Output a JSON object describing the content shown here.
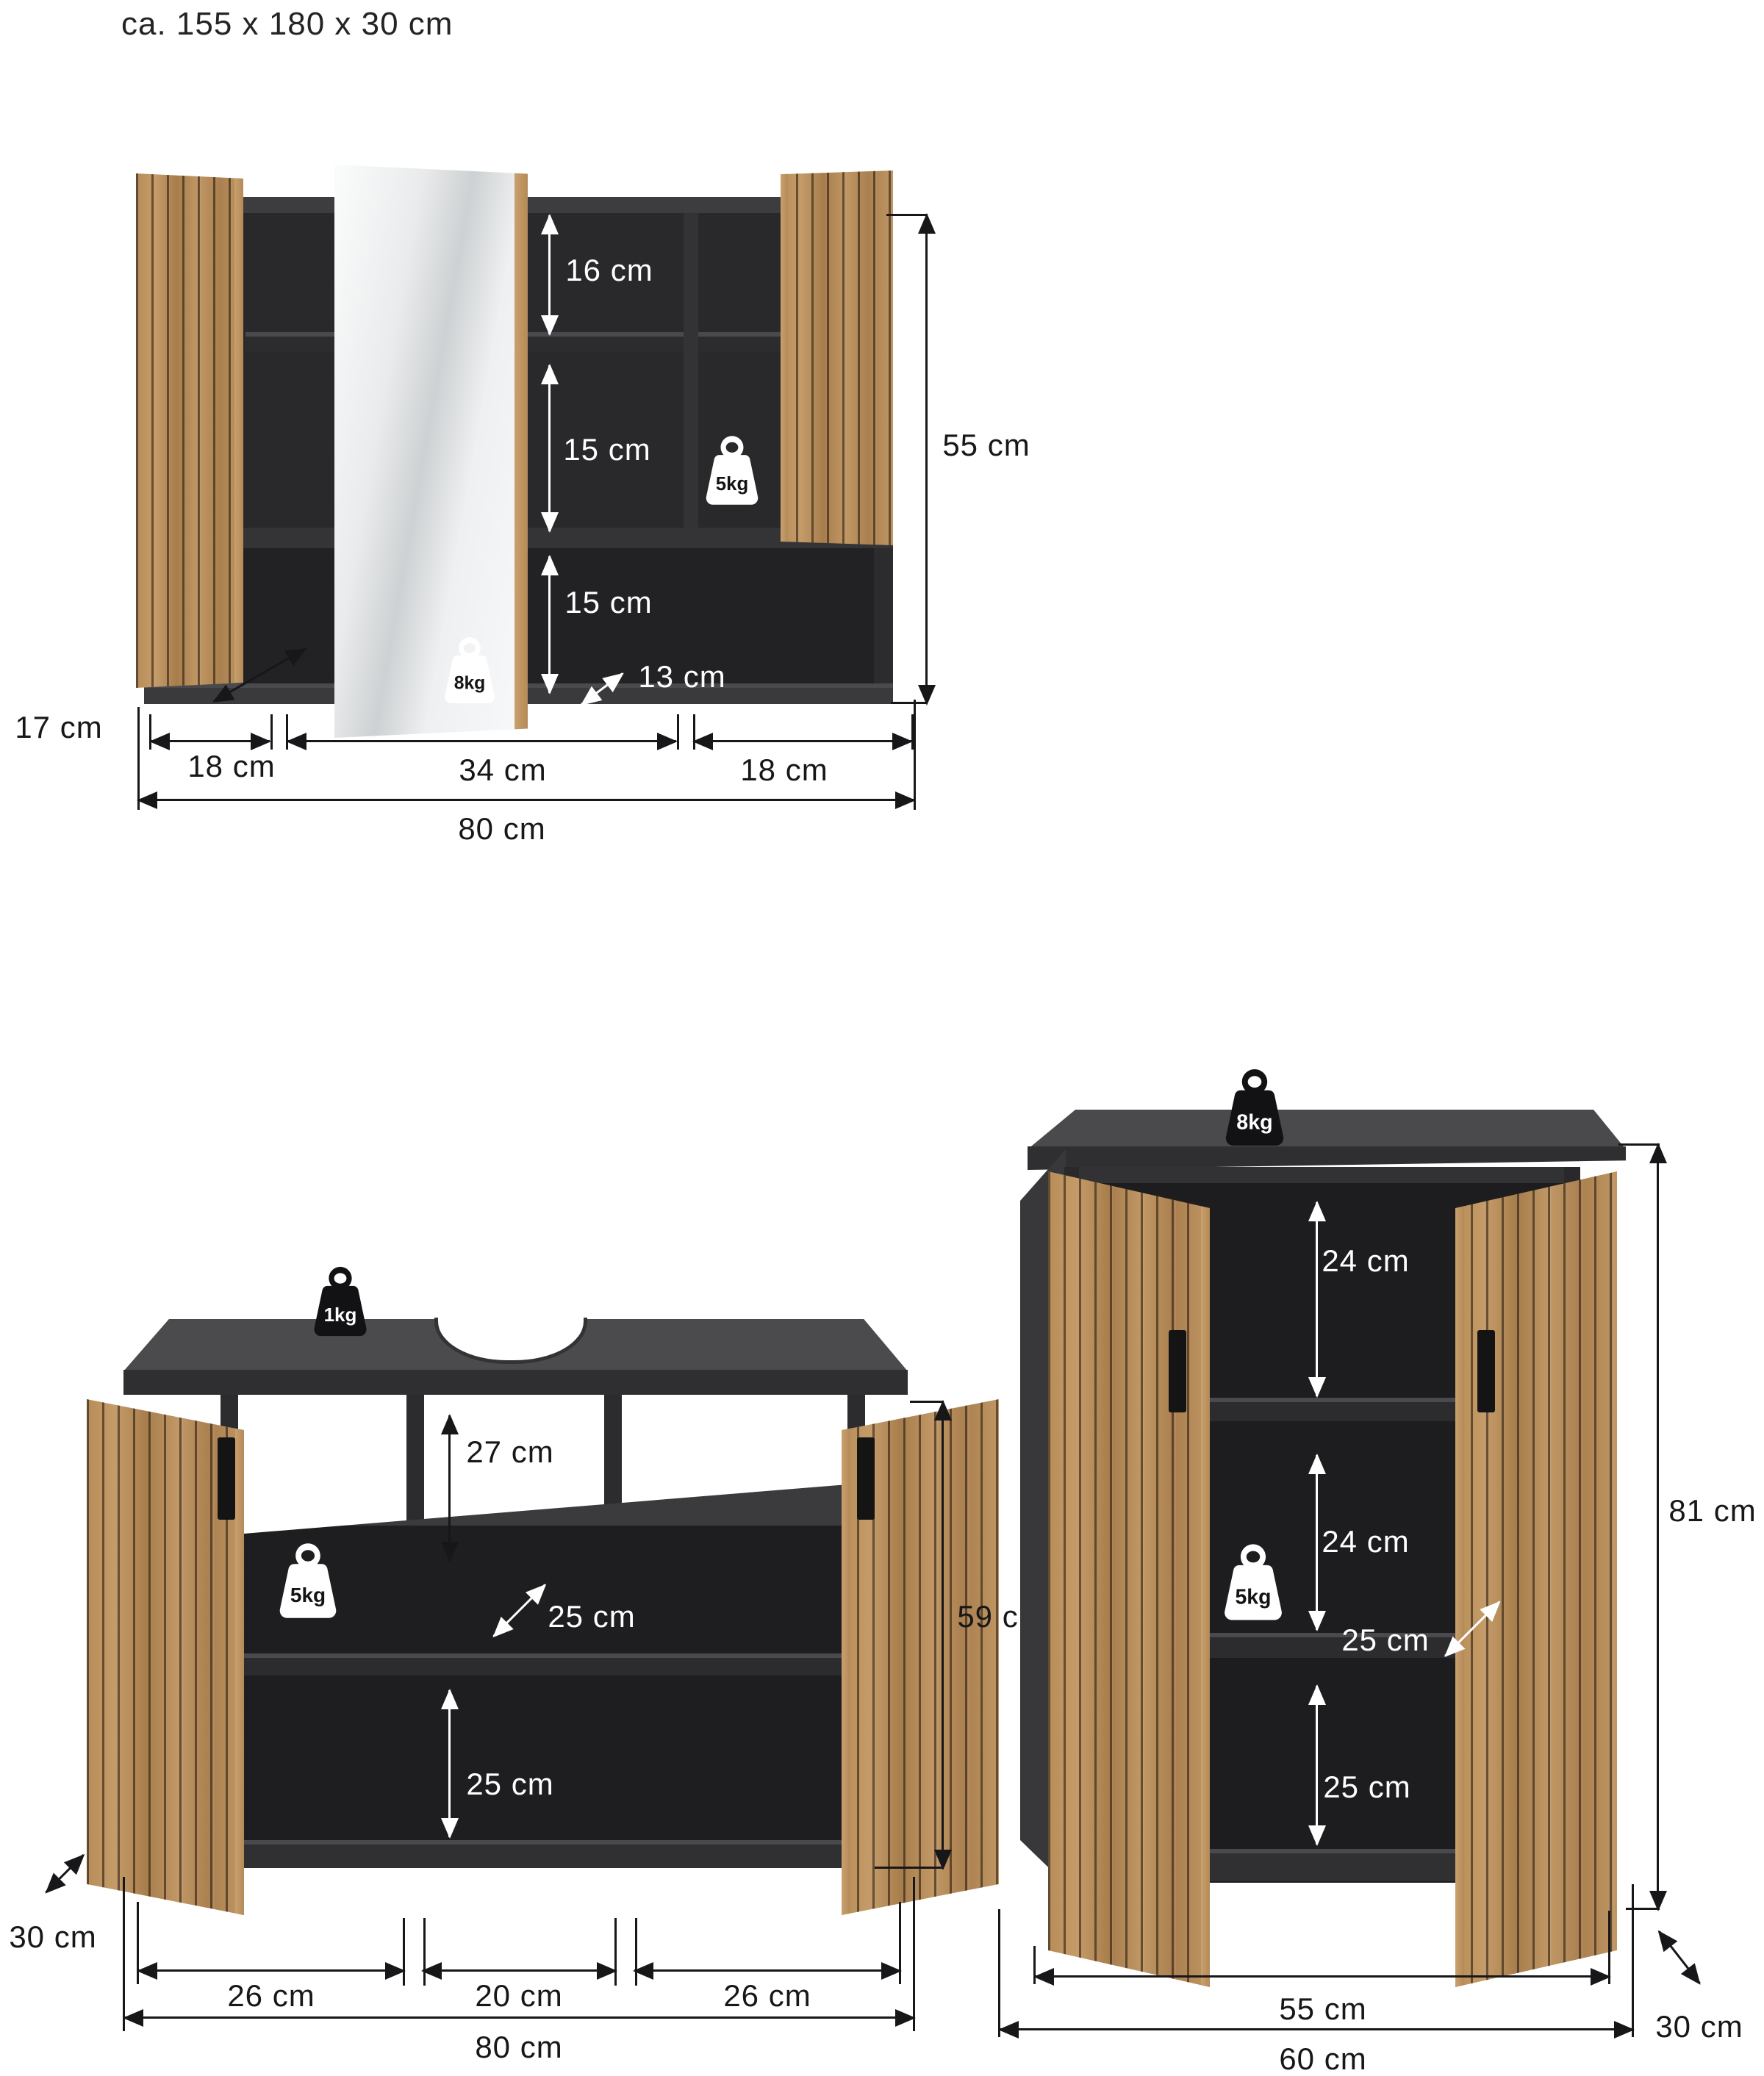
{
  "title": "ca. 155 x 180 x 30 cm",
  "colors": {
    "wood": "#bb9160",
    "carcass_dark": "#2b2b2d",
    "interior_black": "#1e1e20",
    "panel_gray": "#4b4b4e",
    "annotation_black": "#17171a",
    "annotation_white": "#ffffff"
  },
  "mirror_cabinet": {
    "dims": {
      "top_compartment": "16 cm",
      "middle_compartment": "15 cm",
      "open_shelf": "15 cm",
      "niche_depth": "13 cm",
      "height": "55 cm",
      "depth": "17 cm",
      "left_width": "18 cm",
      "center_width": "34 cm",
      "right_width": "18 cm",
      "total_width": "80 cm"
    },
    "load_badges": {
      "compartment": "5kg",
      "open_shelf": "8kg"
    }
  },
  "vanity_cabinet": {
    "dims": {
      "top_compartment": "27 cm",
      "shelf_depth": "25 cm",
      "bottom_compartment": "25 cm",
      "height": "59 cm",
      "depth": "30 cm",
      "left_width": "26 cm",
      "center_width": "20 cm",
      "right_width": "26 cm",
      "total_width": "80 cm"
    },
    "load_badges": {
      "top": "1kg",
      "shelf": "5kg"
    }
  },
  "side_cabinet": {
    "dims": {
      "top_compartment": "24 cm",
      "middle_compartment": "24 cm",
      "shelf_depth": "25 cm",
      "bottom_compartment": "25 cm",
      "height": "81 cm",
      "inner_width": "55 cm",
      "total_width": "60 cm",
      "depth": "30 cm"
    },
    "load_badges": {
      "top": "8kg",
      "shelf": "5kg"
    }
  }
}
